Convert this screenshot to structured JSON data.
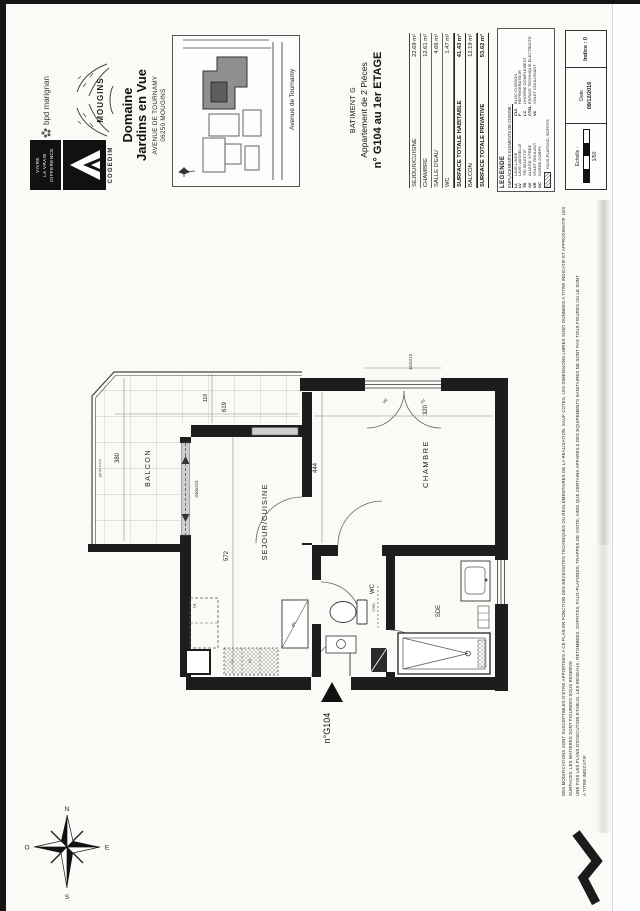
{
  "colors": {
    "paper": "#fbfaf7",
    "ink": "#1a1a1a",
    "wall": "#1d1d1d",
    "tile": "#b4b4b4",
    "glass": "#cfcfcf"
  },
  "branding": {
    "bpd_label": "bpd marignan",
    "cogedim_name": "COGEDIM",
    "cogedim_tagline": [
      "VIVRE",
      "LA VRAIE",
      "DIFFERENCE"
    ],
    "mougins_label": "MOUGINS"
  },
  "header": {
    "title_line1": "Domaine",
    "title_line2": "Jardins en Vue",
    "address_line1": "AVENUE DE TOURNAMY",
    "address_line2": "06250 MOUGINS"
  },
  "site_map": {
    "street_label": "Avenue de Tournamy"
  },
  "apartment": {
    "building": "BATIMENT G",
    "type": "Appartement de 2 Pièces",
    "unit": "n° G104 au 1er ETAGE"
  },
  "surface_table": {
    "rows": [
      {
        "label": "SEJOUR/CUISINE",
        "value": "22.69 m²"
      },
      {
        "label": "CHAMBRE",
        "value": "12.61 m²"
      },
      {
        "label": "SALLE D'EAU",
        "value": "4.66 m²"
      },
      {
        "label": "WC",
        "value": "1.47 m²"
      },
      {
        "label": "SURFACE TOTALE HABITABLE",
        "value": "41.43 m²"
      },
      {
        "label": "BALCON",
        "value": "12.19 m²"
      },
      {
        "label": "SURFACE TOTALE PRIVATIVE",
        "value": "53.62 m²"
      }
    ]
  },
  "legend": {
    "title": "LEGENDE",
    "subtitle": "EMPLACEMENTS ELEMENTS DE CUISINE :",
    "col1": [
      {
        "abbr": "LL",
        "label": "LAVE-LINGE"
      },
      {
        "abbr": "LV",
        "label": "LAVE-VAISSELLE"
      },
      {
        "abbr": "TB",
        "label": "TRI SELECTIF"
      },
      {
        "abbr": "AV",
        "label": "ALLEGE VITREE"
      },
      {
        "abbr": "VR",
        "label": "VOLET ROULANT"
      },
      {
        "abbr": "GC",
        "label": "GARDE-CORPS"
      }
    ],
    "col2": [
      {
        "abbr": "CUI",
        "label": "BLOC CUISSON"
      },
      {
        "abbr": "F",
        "label": "REFRIGERATEUR"
      },
      {
        "abbr": "LC",
        "label": "LINGERE COMPLEMENT"
      },
      {
        "abbr": "CTEL",
        "label": "ESPACE TECHNIQUE ELECTRICITE"
      },
      {
        "abbr": "VC",
        "label": "VOLET COULISSANT"
      }
    ],
    "hatch_label": "FAUX-PLAFOND, SOFFITE",
    "beam_label": "RETOMBEE DE POUTRE",
    "footnote": "Hauteur sous plafond des pieces principales sauf indication particuliere : 2.50 m"
  },
  "title_block": {
    "scale_label": "Echelle :",
    "scale_value": "1/50",
    "date_label": "Date",
    "date_value": "09/12/2016",
    "index_label": "Indice : 0"
  },
  "disclaimer": {
    "line1": "DES MODIFICATIONS SONT SUSCEPTIBLES D'ETRE APPORTEES A CE PLAN EN FONCTION DES NECESSITES TECHNIQUES OU REGLEMENTAIRES DE LA REALISATION. SAUF COTES, LES DIMENSIONS LIBRES SONT DONNEES A TITRE INDICATIF ET APPROXIMATIF. LES SURFACES, LES MATIERES SONT FIGUREES SOUS RESERVE",
    "line2": "UNE FOIS LES PLANS D'EXECUTION ETABLIS, LES RESEAUX, RETOMBEES, SOFFITES, FAUX-PLAFONDS, TRAPPES DE VISITE, AINSI QUE CERTAINS APPAREILS DES EQUIPEMENTS SANITAIRES NE SONT PAS TOUS FIGURES OU LE SONT",
    "line3": "A TITRE INDICATIF."
  },
  "plan": {
    "rooms": {
      "balcon": "BALCON",
      "sejour": "SEJOUR/CUISINE",
      "chambre": "CHAMBRE",
      "wc": "WC",
      "sde": "SDE",
      "placard": "PL"
    },
    "fixtures": {
      "tb": "TB",
      "ll": "LL",
      "lv": "LV",
      "ctel": "CTEL"
    },
    "dims": {
      "balcon_width": "380",
      "balcon_length": "619",
      "d118": "118",
      "sejour_length": "572",
      "chambre_length": "444",
      "chambre_width": "320",
      "bay_window": "340x215",
      "chambre_window": "140x215",
      "garde_corps": "garde-corps"
    },
    "window_tags": {
      "av": "AV",
      "vr": "VR"
    },
    "unit_arrow_label": "n°G104"
  },
  "compass": {
    "n": "N",
    "e": "E",
    "s": "S",
    "o": "O"
  }
}
